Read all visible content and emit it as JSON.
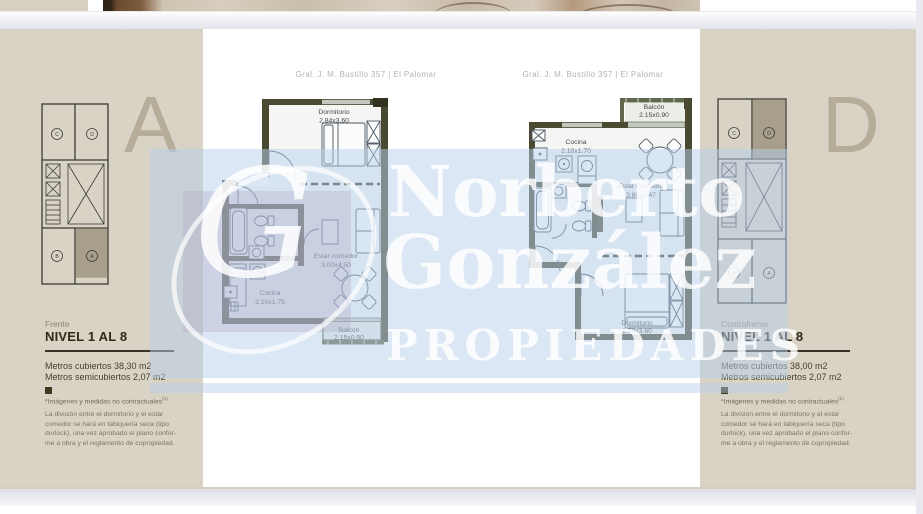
{
  "colors": {
    "panel_beige": "#d9d3c5",
    "wall_olive": "#4a4a33",
    "balcony_olive": "#5f684a",
    "watermark_overlay_blue": "#b7cfeb",
    "accent_dark": "#3a3226",
    "section_letter_color": "#b5ad9a"
  },
  "watermark": {
    "name_line1": "Norberto",
    "name_line2": "González",
    "subtitle": "PROPIEDADES",
    "monogram": "G"
  },
  "unit_a": {
    "letter": "A",
    "address": "Gral. J. M. Bustillo 357  |  El Palomar",
    "orientation": "Frente",
    "level": "NIVEL 1 AL 8",
    "area_covered": "Metros cubiertos 38,30 m2",
    "area_semi": "Metros semicubiertos 2,07 m2",
    "note": "*Imágenes y medidas no contractuales",
    "note_sup": "(1)",
    "legal_lines": [
      "La división entre el dormitorio y el estar",
      "comedor se hará en tabiquería seca (tipo",
      "durlock), una vez aprobado el plano confor-",
      "me a obra y el reglamento de copropiedad."
    ],
    "rooms": {
      "dormitorio": "Dormitorio",
      "dormitorio_size": "2.84x3.60",
      "cocina": "Cocina",
      "cocina_size": "2.10x1.75",
      "estar": "Estar comedor",
      "estar_size": "3.00x4.50",
      "balcon": "Balcón",
      "balcon_size": "2.15x0.90"
    },
    "keyplan": {
      "top_left": "C",
      "top_right": "D",
      "bottom_left": "B",
      "bottom_right": "A"
    }
  },
  "unit_d": {
    "letter": "D",
    "address": "Gral. J. M. Bustillo 357  |  El Palomar",
    "orientation": "Contrafrente",
    "level": "NIVEL 1 AL 8",
    "area_covered": "Metros cubiertos 38,00 m2",
    "area_semi": "Metros semicubiertos 2,07 m2",
    "note": "*Imágenes y medidas no contractuales",
    "note_sup": "(1)",
    "legal_lines": [
      "La división entre el dormitorio y el estar",
      "comedor se hará en tabiquería seca (tipo",
      "durlock), una vez aprobado el plano confor-",
      "me a obra y el reglamento de copropiedad."
    ],
    "rooms": {
      "balcon": "Balcón",
      "balcon_size": "2.15x0.90",
      "cocina": "Cocina",
      "cocina_size": "2.10x1.70",
      "estar": "Estar Comedor",
      "estar_size": "3.60x4.47",
      "dormitorio": "Dormitorio",
      "dormitorio_size": "2.79x3.60"
    },
    "keyplan": {
      "top_left": "C",
      "top_right": "D",
      "bottom_left": "B",
      "bottom_right": "A"
    }
  }
}
